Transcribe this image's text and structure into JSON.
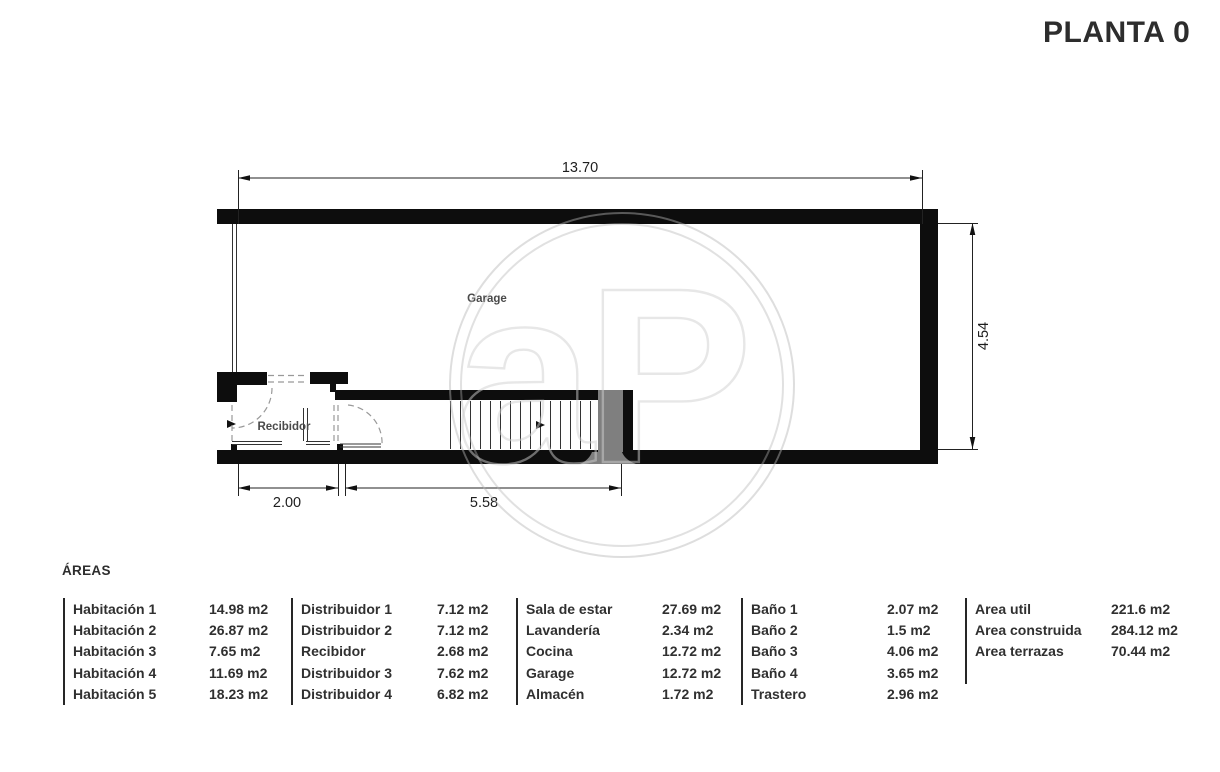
{
  "title": "PLANTA 0",
  "plan": {
    "labels": {
      "garage": "Garage",
      "recibidor": "Recibidor"
    },
    "dimensions": {
      "width_total": "13.70",
      "height_right": "4.54",
      "recibidor_width": "2.00",
      "stairs_width": "5.58"
    },
    "watermark": "aP",
    "colors": {
      "wall": "#0d0d0d",
      "stair_landing": "#7f7f7f",
      "dashed_door": "#999999"
    }
  },
  "areas": {
    "heading": "ÁREAS",
    "groups": [
      {
        "items": [
          {
            "label": "Habitación 1",
            "value": "14.98 m2"
          },
          {
            "label": "Habitación 2",
            "value": "26.87 m2"
          },
          {
            "label": "Habitación 3",
            "value": "7.65 m2"
          },
          {
            "label": "Habitación 4",
            "value": "11.69 m2"
          },
          {
            "label": "Habitación 5",
            "value": "18.23 m2"
          }
        ]
      },
      {
        "items": [
          {
            "label": "Distribuidor 1",
            "value": "7.12 m2"
          },
          {
            "label": "Distribuidor 2",
            "value": "7.12 m2"
          },
          {
            "label": "Recibidor",
            "value": "2.68 m2"
          },
          {
            "label": "Distribuidor 3",
            "value": "7.62 m2"
          },
          {
            "label": "Distribuidor 4",
            "value": "6.82 m2"
          }
        ]
      },
      {
        "items": [
          {
            "label": "Sala de estar",
            "value": "27.69 m2"
          },
          {
            "label": "Lavandería",
            "value": "2.34 m2"
          },
          {
            "label": "Cocina",
            "value": "12.72 m2"
          },
          {
            "label": "Garage",
            "value": "12.72 m2"
          },
          {
            "label": "Almacén",
            "value": "1.72 m2"
          }
        ]
      },
      {
        "items": [
          {
            "label": "Baño 1",
            "value": "2.07 m2"
          },
          {
            "label": "Baño 2",
            "value": "1.5 m2"
          },
          {
            "label": "Baño 3",
            "value": "4.06 m2"
          },
          {
            "label": "Baño 4",
            "value": "3.65 m2"
          },
          {
            "label": "Trastero",
            "value": "2.96 m2"
          }
        ]
      },
      {
        "items": [
          {
            "label": "Area util",
            "value": "221.6 m2"
          },
          {
            "label": "Area construida",
            "value": "284.12 m2"
          },
          {
            "label": "Area terrazas",
            "value": "70.44 m2"
          }
        ]
      }
    ]
  }
}
